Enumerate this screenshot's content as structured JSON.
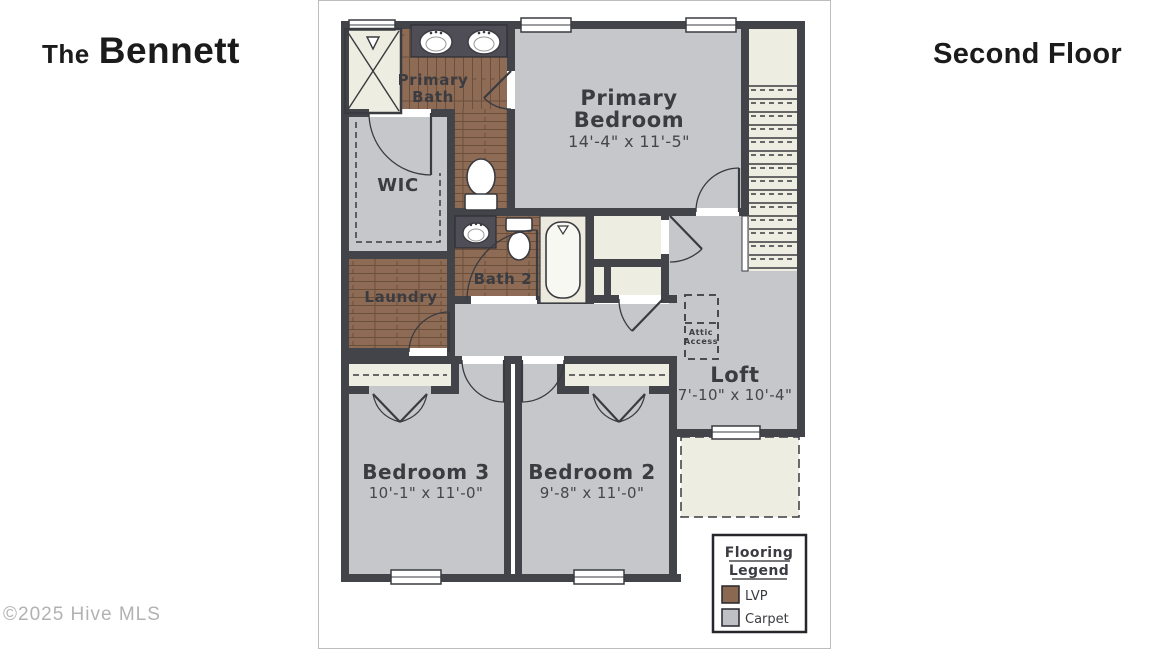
{
  "header": {
    "title_prefix": "The",
    "title_name": "Bennett",
    "floor": "Second Floor"
  },
  "watermark": "©2025 Hive MLS",
  "rooms": {
    "primary_bath": {
      "line1": "Primary",
      "line2": "Bath"
    },
    "primary_bedroom": {
      "line1": "Primary",
      "line2": "Bedroom",
      "dims": "14'-4\" x 11'-5\""
    },
    "wic": {
      "name": "WIC"
    },
    "bath2": {
      "name": "Bath 2"
    },
    "laundry": {
      "name": "Laundry"
    },
    "attic": {
      "line1": "Attic",
      "line2": "Access"
    },
    "loft": {
      "name": "Loft",
      "dims": "7'-10\" x 10'-4\""
    },
    "bedroom3": {
      "name": "Bedroom 3",
      "dims": "10'-1\" x 11'-0\""
    },
    "bedroom2": {
      "name": "Bedroom 2",
      "dims": "9'-8\" x 11'-0\""
    }
  },
  "legend": {
    "title_line1": "Flooring",
    "title_line2": "Legend",
    "items": [
      {
        "label": "LVP",
        "color": "#8a6852"
      },
      {
        "label": "Carpet",
        "color": "#bfc0c6"
      }
    ]
  },
  "colors": {
    "wall": "#43444a",
    "carpet": "#c6c7cb",
    "lvp": "#8d6b55",
    "cream": "#eeede1",
    "counter": "#4f4e57",
    "fixture_white": "#f8f8f2"
  }
}
